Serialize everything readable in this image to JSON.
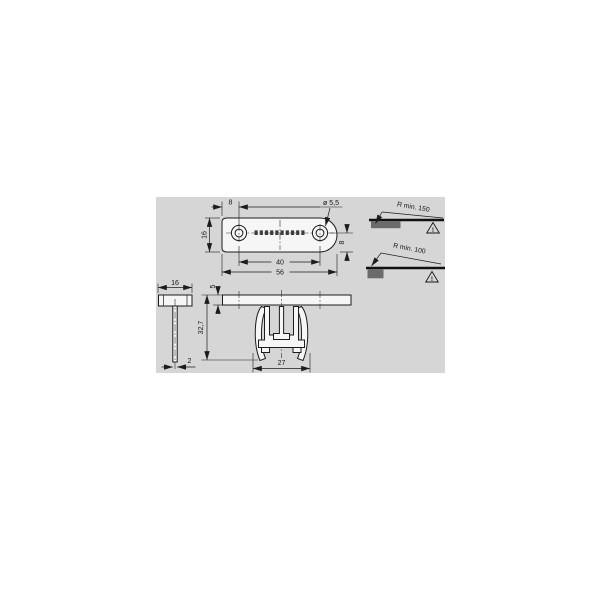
{
  "panel": {
    "bg_color": "#d6d6d6",
    "line_color": "#1c1c1c",
    "part_fill_color": "#f6f6f6",
    "bend_block_color": "#6b6b6b"
  },
  "top_view": {
    "dim_edge_to_hole": "8",
    "hole_diameter": "ø 5,5",
    "dim_width": "16",
    "dim_center_to_edge": "8",
    "dim_hole_spacing": "40",
    "dim_length": "56"
  },
  "bend_notes": [
    {
      "label": "R min. 150",
      "warning": "!"
    },
    {
      "label": "R min. 100",
      "warning": "!"
    }
  ],
  "side_section": {
    "dim_width": "16",
    "dim_thickness": "2"
  },
  "front_section": {
    "dim_plate_thickness": "5",
    "dim_height": "32,7",
    "dim_clip_width": "27"
  }
}
